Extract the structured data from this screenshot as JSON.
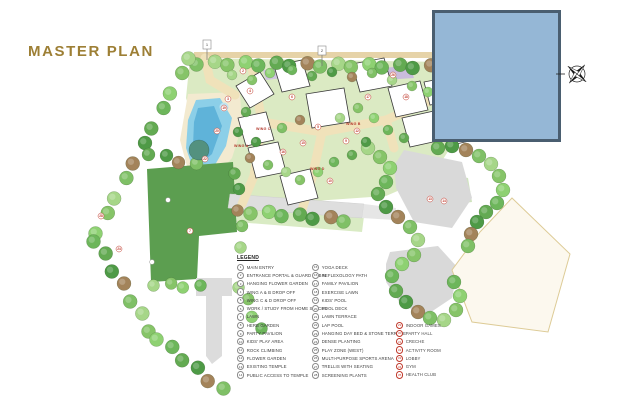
{
  "title": "MASTER PLAN",
  "colors": {
    "title_gold": "#9d7f35",
    "cover_box_fill": "#95b7d6",
    "cover_box_border": "#4a5e70",
    "pool_blue": "#8ccfe8",
    "lawn_green": "#5c9e50",
    "path_cream": "#f0e2ba",
    "road_gray": "#dcdcdc",
    "marker_red": "#c0392b"
  },
  "legend": {
    "heading": "LEGEND",
    "columns": [
      {
        "accent": "gray",
        "items": [
          {
            "n": "1",
            "label": "MAIN ENTRY"
          },
          {
            "n": "2",
            "label": "ENTRANCE PORTAL & GUARD CABIN"
          },
          {
            "n": "3",
            "label": "HANGING FLOWER GARDEN"
          },
          {
            "n": "4",
            "label": "WING A & B DROP OFF"
          },
          {
            "n": "5",
            "label": "WING C & D DROP OFF"
          },
          {
            "n": "6",
            "label": "WORK / STUDY FROM HOME SPACES"
          },
          {
            "n": "7",
            "label": "LAWN"
          },
          {
            "n": "8",
            "label": "HERB GARDEN"
          },
          {
            "n": "9",
            "label": "PARTY PAVILION"
          },
          {
            "n": "10",
            "label": "KIDS' PLAY AREA"
          },
          {
            "n": "11",
            "label": "ROCK CLIMBING"
          },
          {
            "n": "12",
            "label": "FLOWER GARDEN"
          },
          {
            "n": "13",
            "label": "EXISTING TEMPLE"
          },
          {
            "n": "14",
            "label": "PUBLIC ACCESS TO TEMPLE"
          }
        ]
      },
      {
        "accent": "gray",
        "items": [
          {
            "n": "15",
            "label": "YOGA DECK"
          },
          {
            "n": "16",
            "label": "REFLEXOLOGY PATH"
          },
          {
            "n": "17",
            "label": "FAMILY PAVILION"
          },
          {
            "n": "18",
            "label": "EXERCISE LAWN"
          },
          {
            "n": "19",
            "label": "KIDS' POOL"
          },
          {
            "n": "20",
            "label": "POOL DECK"
          },
          {
            "n": "21",
            "label": "LAWN TERRACE"
          },
          {
            "n": "22",
            "label": "LAP POOL"
          },
          {
            "n": "23",
            "label": "HANGING DAY BED & STONE TERRACE"
          },
          {
            "n": "24",
            "label": "DENSE PLANTING"
          },
          {
            "n": "25",
            "label": "PLAY ZONE (WEST)"
          },
          {
            "n": "26",
            "label": "MULTI-PURPOSE SPORTS ARENA"
          },
          {
            "n": "27",
            "label": "TRELLIS WITH SEATING"
          },
          {
            "n": "28",
            "label": "SCREENING PLANTS"
          }
        ]
      },
      {
        "accent": "red",
        "items": [
          {
            "n": "29",
            "label": "INDOOR GAMES"
          },
          {
            "n": "30",
            "label": "PARTY HALL"
          },
          {
            "n": "31",
            "label": "CRECHE"
          },
          {
            "n": "32",
            "label": "ACTIVITY ROOM"
          },
          {
            "n": "33",
            "label": "LOBBY"
          },
          {
            "n": "34",
            "label": "GYM"
          },
          {
            "n": "35",
            "label": "HEALTH CLUB"
          }
        ]
      }
    ]
  },
  "map": {
    "wing_labels": [
      {
        "text": "WING A",
        "x": 234,
        "y": 147
      },
      {
        "text": "WING B",
        "x": 346,
        "y": 125
      },
      {
        "text": "WING C",
        "x": 256,
        "y": 130
      },
      {
        "text": "WING D",
        "x": 310,
        "y": 170
      }
    ],
    "markers": [
      {
        "n": "2",
        "x": 243,
        "y": 71
      },
      {
        "n": "3",
        "x": 228,
        "y": 99
      },
      {
        "n": "4",
        "x": 250,
        "y": 91
      },
      {
        "n": "5",
        "x": 318,
        "y": 127
      },
      {
        "n": "6",
        "x": 292,
        "y": 97
      },
      {
        "n": "7",
        "x": 190,
        "y": 231
      },
      {
        "n": "9",
        "x": 346,
        "y": 141
      },
      {
        "n": "10",
        "x": 330,
        "y": 181
      },
      {
        "n": "12",
        "x": 357,
        "y": 131
      },
      {
        "n": "13",
        "x": 430,
        "y": 199
      },
      {
        "n": "14",
        "x": 444,
        "y": 201
      },
      {
        "n": "15",
        "x": 303,
        "y": 143
      },
      {
        "n": "16",
        "x": 283,
        "y": 152
      },
      {
        "n": "17",
        "x": 368,
        "y": 97
      },
      {
        "n": "18",
        "x": 406,
        "y": 97
      },
      {
        "n": "19",
        "x": 224,
        "y": 108
      },
      {
        "n": "20",
        "x": 217,
        "y": 131
      },
      {
        "n": "22",
        "x": 205,
        "y": 159
      },
      {
        "n": "24",
        "x": 119,
        "y": 249
      },
      {
        "n": "26",
        "x": 393,
        "y": 75
      },
      {
        "n": "28",
        "x": 101,
        "y": 216
      }
    ],
    "flags": [
      {
        "n": "1",
        "x": 207,
        "y": 40
      },
      {
        "n": "2",
        "x": 322,
        "y": 46
      }
    ]
  }
}
